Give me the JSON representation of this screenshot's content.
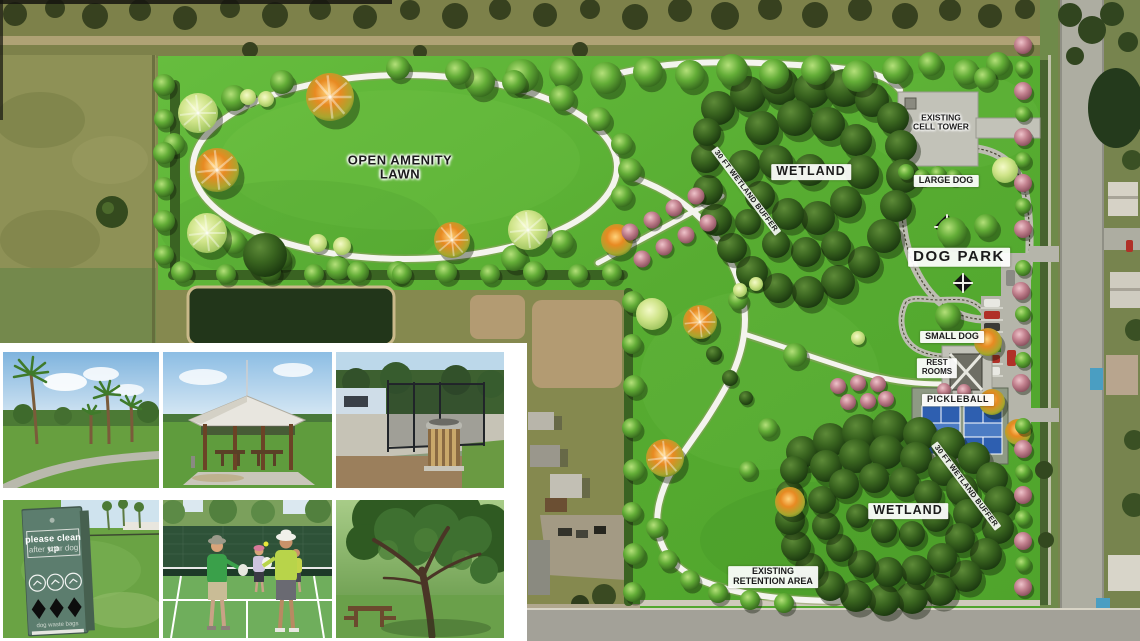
{
  "plan": {
    "labels": {
      "open_lawn_1": "OPEN AMENITY",
      "open_lawn_2": "LAWN",
      "wetland_top": "WETLAND",
      "buffer_top": "30 FT WETLAND BUFFER",
      "cell_tower_1": "EXISTING",
      "cell_tower_2": "CELL TOWER",
      "large_dog": "LARGE DOG",
      "dog_park": "DOG PARK",
      "small_dog": "SMALL DOG",
      "restrooms_1": "REST",
      "restrooms_2": "ROOMS",
      "pickleball": "PICKLEBALL",
      "buffer_bottom": "30 FT WETLAND BUFFER",
      "wetland_bottom": "WETLAND",
      "retention_1": "EXISTING",
      "retention_2": "RETENTION AREA"
    },
    "colors": {
      "lawn_green": "#5eb837",
      "wetland_green": "#2f5a1d",
      "path_white": "#f4f4ee",
      "flowering_tree_pink": "#c2818e",
      "court_blue": "#2e5fb0",
      "pavement_gray": "#c2c2b8",
      "sign_green": "#5c7d6e"
    }
  },
  "photos": {
    "items": [
      {
        "name": "palm-lined-path"
      },
      {
        "name": "picnic-pavilion"
      },
      {
        "name": "dog-park-fence-trash-can"
      },
      {
        "name": "dog-waste-station-sign"
      },
      {
        "name": "pickleball-players"
      },
      {
        "name": "oak-tree-picnic-table"
      }
    ],
    "sign": {
      "line1": "please clean up",
      "line2": "after your dog",
      "footer": "dog waste bags"
    }
  }
}
